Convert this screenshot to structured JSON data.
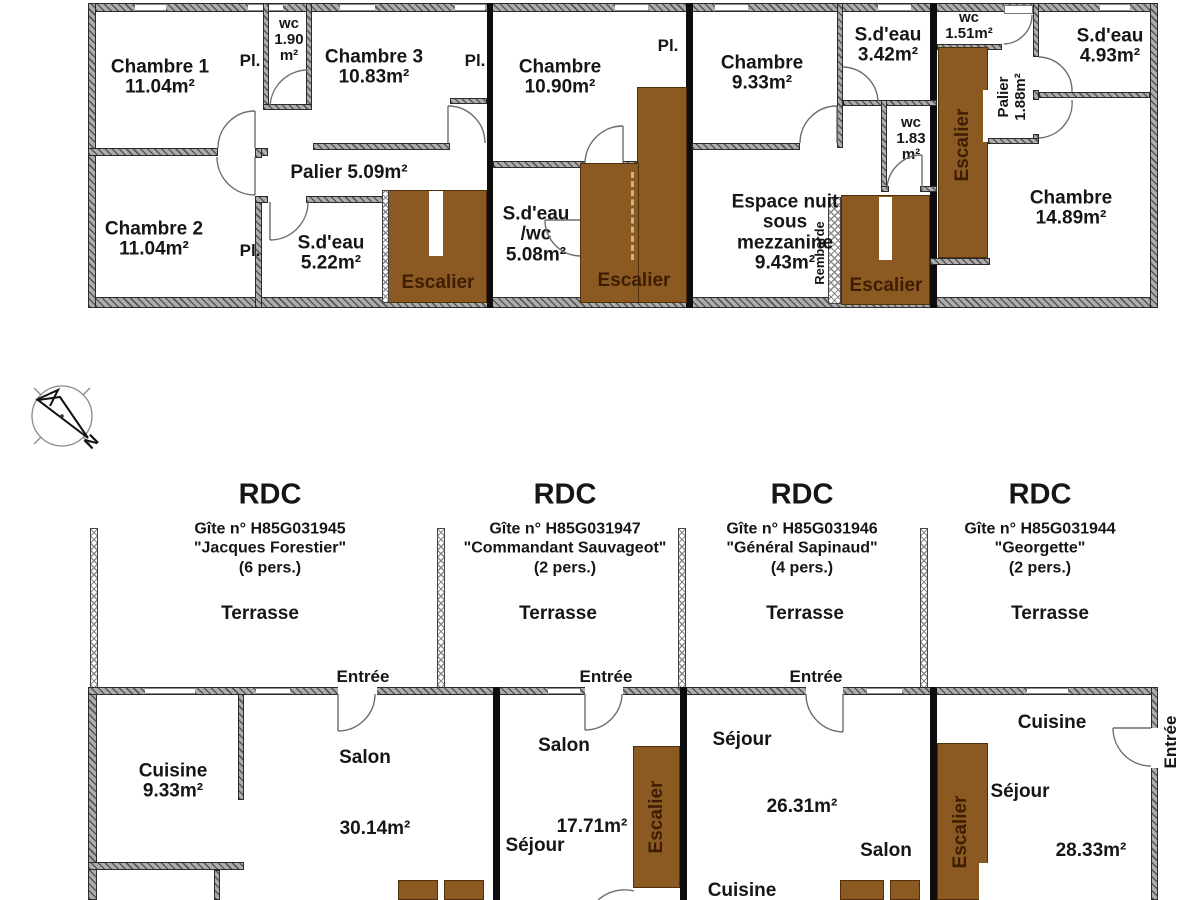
{
  "colors": {
    "stair_fill": "#8a5a22",
    "stair_border": "#4f3008",
    "stair_text": "#401d02",
    "wall_gray": "#adadad",
    "divider_black": "#0d0d0d"
  },
  "compass": {
    "north": "N"
  },
  "upper": {
    "g1": {
      "chambre1": "Chambre 1\n11.04m²",
      "pl_top": "Pl.",
      "wc": "wc\n1.90\nm²",
      "chambre3": "Chambre 3\n10.83m²",
      "pl_right": "Pl.",
      "palier": "Palier 5.09m²",
      "chambre2": "Chambre 2\n11.04m²",
      "pl_bottom": "Pl.",
      "sdeau": "S.d'eau\n5.22m²",
      "escalier": "Escalier"
    },
    "g2": {
      "chambre": "Chambre\n10.90m²",
      "pl": "Pl.",
      "sdeau": "S.d'eau\n/wc\n5.08m²",
      "escalier": "Escalier"
    },
    "g3": {
      "chambre": "Chambre\n9.33m²",
      "sdeau": "S.d'eau\n3.42m²",
      "wc": "wc\n1.83\nm²",
      "espace": "Espace nuit\nsous\nmezzanine\n9.43m²",
      "rembarde": "Rembarde",
      "escalier": "Escalier"
    },
    "g4": {
      "wc": "wc\n1.51m²",
      "sdeau": "S.d'eau\n4.93m²",
      "escalier": "Escalier",
      "palier_line1": "Palier",
      "palier_line2": "1.88m²",
      "chambre": "Chambre\n14.89m²"
    }
  },
  "headers": {
    "g1": {
      "floor": "RDC",
      "gite": "Gîte n° H85G031945",
      "name": "\"Jacques Forestier\"",
      "capacity": "(6 pers.)",
      "terrasse": "Terrasse",
      "entree": "Entrée"
    },
    "g2": {
      "floor": "RDC",
      "gite": "Gîte n° H85G031947",
      "name": "\"Commandant Sauvageot\"",
      "capacity": "(2 pers.)",
      "terrasse": "Terrasse",
      "entree": "Entrée"
    },
    "g3": {
      "floor": "RDC",
      "gite": "Gîte n° H85G031946",
      "name": "\"Général Sapinaud\"",
      "capacity": "(4 pers.)",
      "terrasse": "Terrasse",
      "entree": "Entrée"
    },
    "g4": {
      "floor": "RDC",
      "gite": "Gîte n° H85G031944",
      "name": "\"Georgette\"",
      "capacity": "(2 pers.)",
      "terrasse": "Terrasse",
      "entree": "Entrée"
    }
  },
  "lower": {
    "g1": {
      "cuisine": "Cuisine\n9.33m²",
      "salon": "Salon",
      "area": "30.14m²"
    },
    "g2": {
      "salon": "Salon",
      "area": "17.71m²",
      "sejour": "Séjour",
      "escalier": "Escalier"
    },
    "g3": {
      "sejour": "Séjour",
      "area": "26.31m²",
      "salon": "Salon",
      "cuisine": "Cuisine"
    },
    "g4": {
      "cuisine": "Cuisine",
      "sejour": "Séjour",
      "area": "28.33m²",
      "escalier": "Escalier",
      "entree": "Entrée"
    }
  }
}
